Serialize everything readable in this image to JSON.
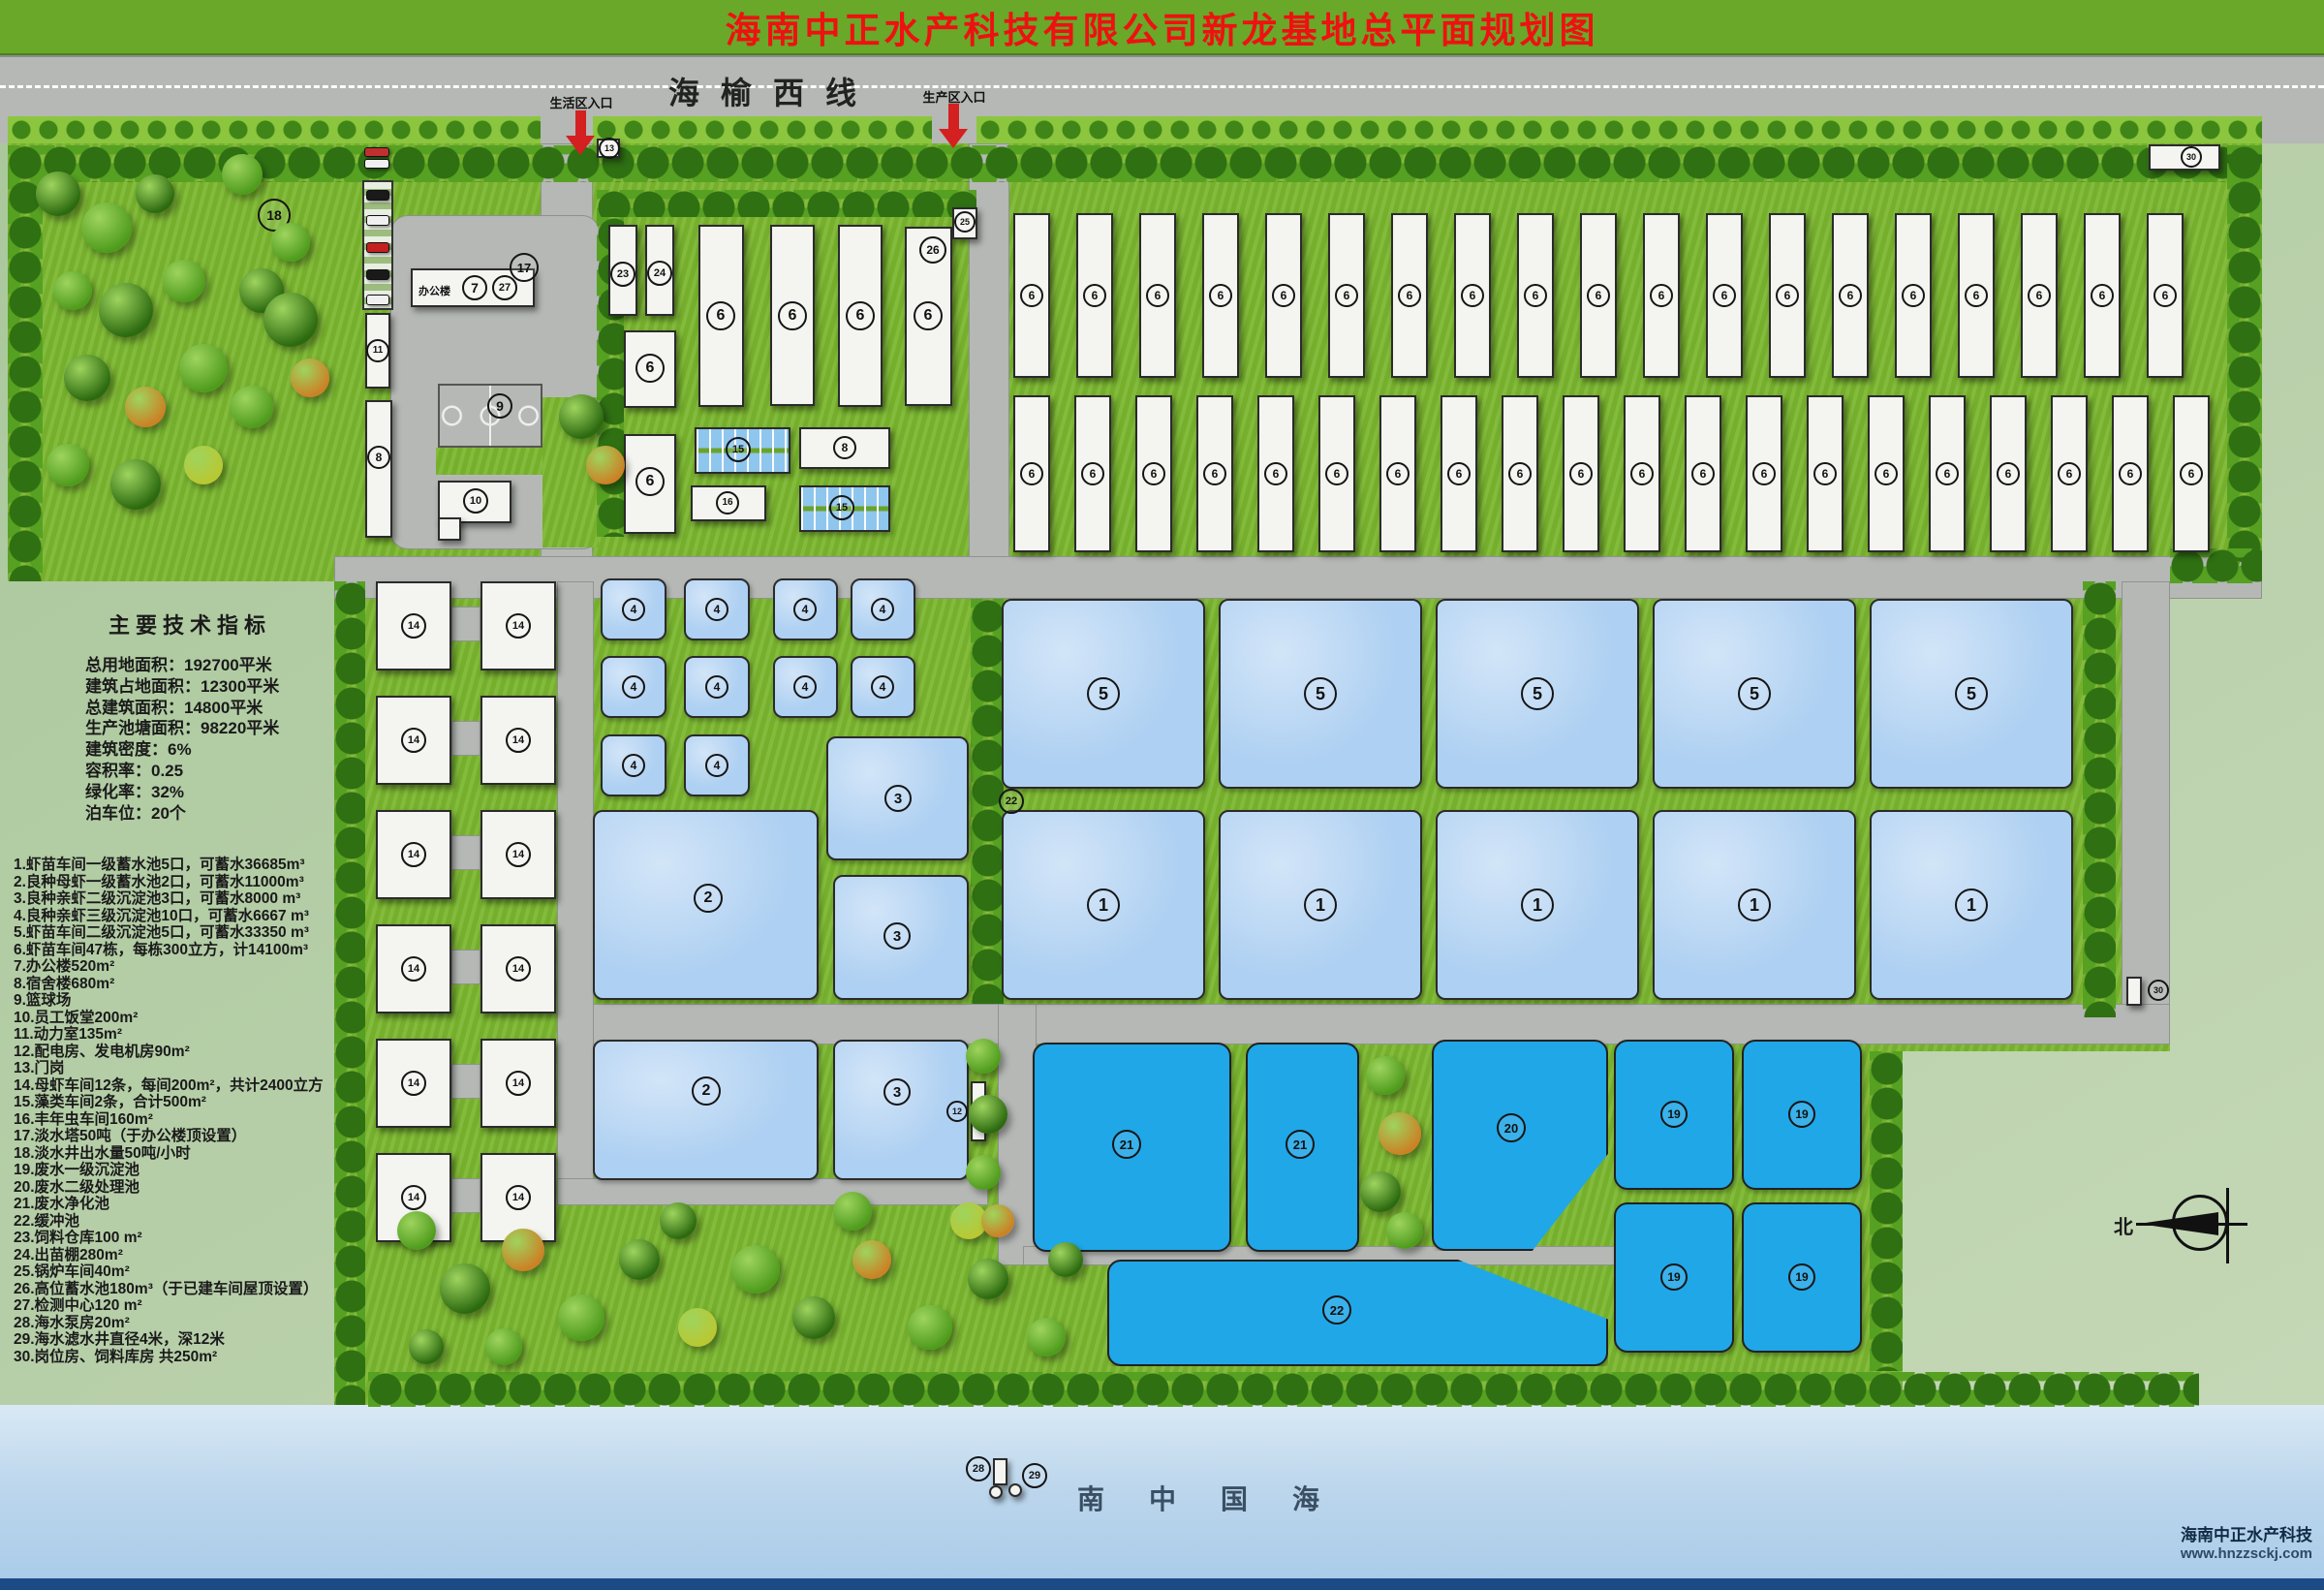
{
  "title": "海南中正水产科技有限公司新龙基地总平面规划图",
  "road": {
    "label": "海榆西线",
    "entrance_living": "生活区入口",
    "entrance_production": "生产区入口"
  },
  "indicators": {
    "title": "主要技术指标",
    "lines": [
      "总用地面积：192700平米",
      "建筑占地面积：12300平米",
      "总建筑面积：14800平米",
      "生产池塘面积：98220平米",
      "建筑密度：6%",
      "容积率：0.25",
      "绿化率：32%",
      "泊车位：20个"
    ]
  },
  "legend": [
    "1.虾苗车间一级蓄水池5口，可蓄水36685m³",
    "2.良种母虾一级蓄水池2口，可蓄水11000m³",
    "3.良种亲虾二级沉淀池3口，可蓄水8000 m³",
    "4.良种亲虾三级沉淀池10口，可蓄水6667 m³",
    "5.虾苗车间二级沉淀池5口，可蓄水33350 m³",
    "6.虾苗车间47栋，每栋300立方，计14100m³",
    "7.办公楼520m²",
    "8.宿舍楼680m²",
    "9.篮球场",
    "10.员工饭堂200m²",
    "11.动力室135m²",
    "12.配电房、发电机房90m²",
    "13.门岗",
    "14.母虾车间12条，每间200m²，共计2400立方",
    "15.藻类车间2条，合计500m²",
    "16.丰年虫车间160m²",
    "17.淡水塔50吨（于办公楼顶设置）",
    "18.淡水井出水量50吨/小时",
    "19.废水一级沉淀池",
    "20.废水二级处理池",
    "21.废水净化池",
    "22.缓冲池",
    "23.饲料仓库100 m²",
    "24.出苗棚280m²",
    "25.锅炉车间40m²",
    "26.高位蓄水池180m³（于已建车间屋顶设置）",
    "27.检测中心120 m²",
    "28.海水泵房20m²",
    "29.海水滤水井直径4米，深12米",
    "30.岗位房、饲料库房 共250m²"
  ],
  "office_label": "办公楼",
  "compass_north": "北",
  "sea_label": "南中国海",
  "watermark": {
    "company": "海南中正水产科技",
    "website": "www.hnzzsckj.com"
  },
  "markers": {
    "1": "1",
    "2": "2",
    "3": "3",
    "4": "4",
    "5": "5",
    "6": "6",
    "7": "7",
    "8": "8",
    "9": "9",
    "10": "10",
    "11": "11",
    "12": "12",
    "13": "13",
    "14": "14",
    "15": "15",
    "16": "16",
    "17": "17",
    "18": "18",
    "19": "19",
    "20": "20",
    "21": "21",
    "22": "22",
    "23": "23",
    "24": "24",
    "25": "25",
    "26": "26",
    "27": "27",
    "28": "28",
    "29": "29",
    "30": "30"
  },
  "colors": {
    "banner_green": "#69a829",
    "title_text": "#ee1111",
    "road_gray": "#b5b8b5",
    "grass_green": "#7ab62e",
    "pond_light": "#aed0f2",
    "pond_bright": "#1fa7e8",
    "legend_sage": "#a9c79b",
    "sea_blue": "#bcd6ec",
    "arrow_red": "#d42020"
  }
}
